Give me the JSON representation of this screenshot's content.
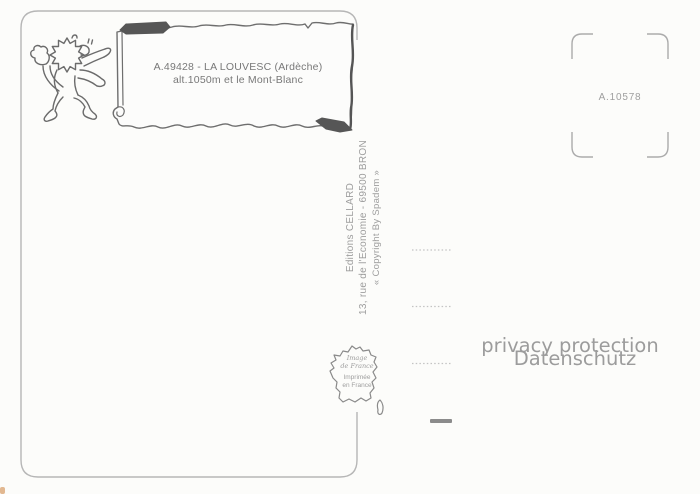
{
  "postcard": {
    "caption": {
      "line1": "A.49428 - LA LOUVESC (Ardèche)",
      "line2": "alt.1050m et le Mont-Blanc"
    },
    "stamp_area": {
      "reference": "A.10578"
    },
    "publisher": {
      "line1": "Editions CELLARD",
      "line2": "13, rue de l'Economie - 69500 BRON",
      "line3": "« Copyright By Spadem »"
    },
    "print_mark": {
      "line1": "Image",
      "line2": "de France",
      "line3": "Imprimée",
      "line4": "en France"
    },
    "watermark": {
      "line1": "privacy protection",
      "line2": "Datenschutz"
    },
    "icons": {
      "lion": "heraldic-lion-icon",
      "banner": "scroll-banner",
      "map": "france-map-icon",
      "stamp_box": "stamp-corner-marks"
    },
    "colors": {
      "background": "#fcfcfa",
      "border_gray": "#b6b6b6",
      "ink_gray": "#6b6b6b",
      "caption_gray": "#787878",
      "light_text_gray": "#9d9d9d",
      "dark_flap": "#565656",
      "watermark_gray": "#9c9c9c"
    }
  }
}
